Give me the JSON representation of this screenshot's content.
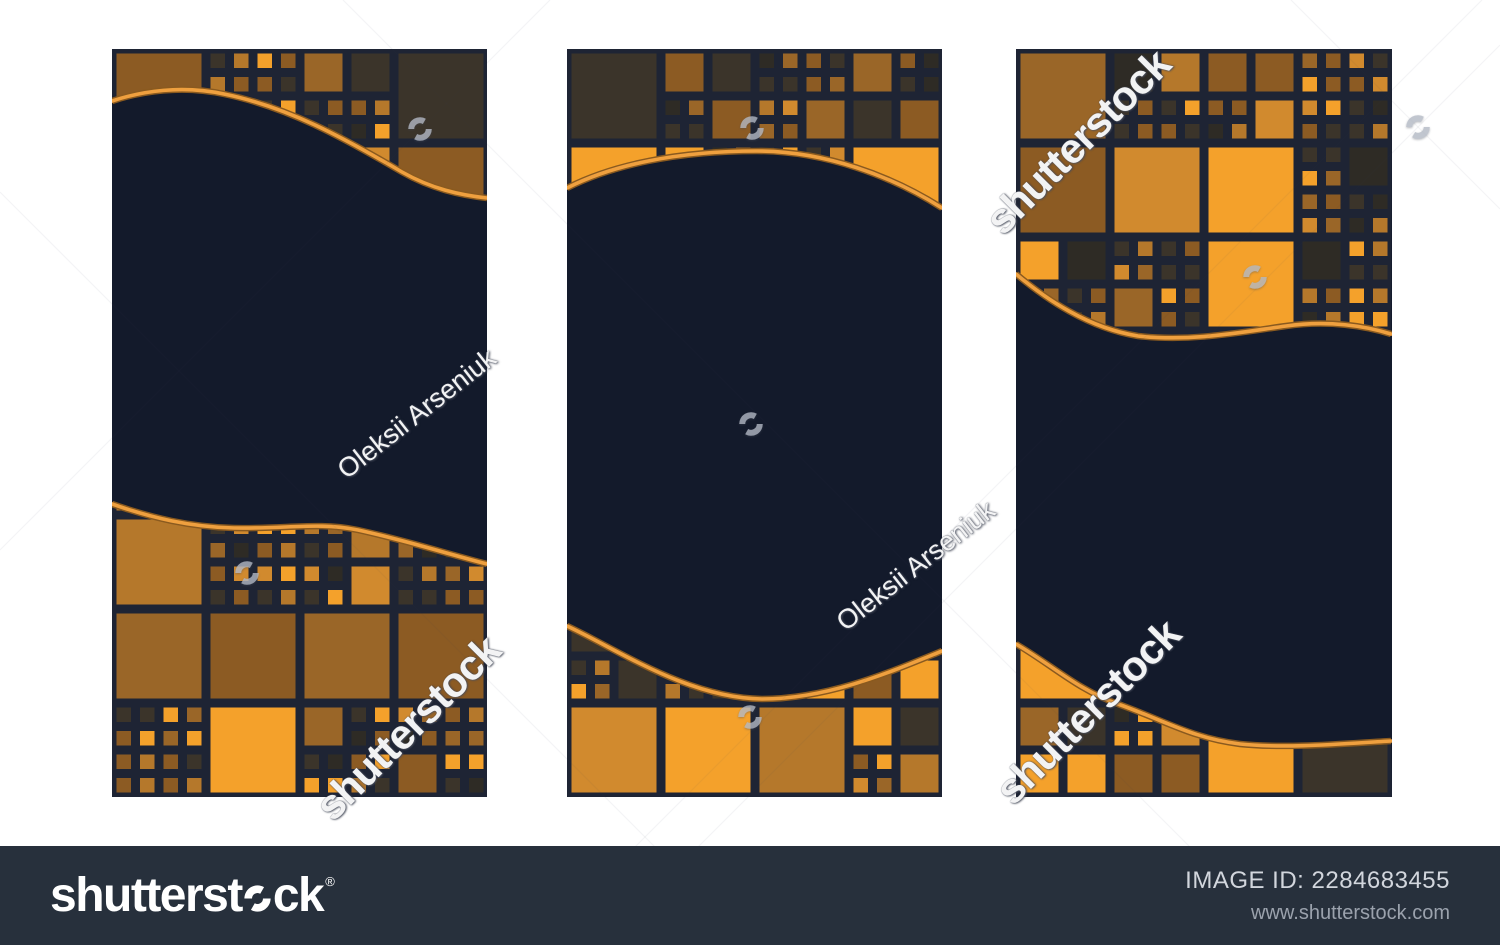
{
  "canvas": {
    "background": "#ffffff",
    "width": 1500,
    "height": 945
  },
  "footer": {
    "bg": "#27303c",
    "logo_prefix": "shutterst",
    "logo_suffix": "ck",
    "registered": "®",
    "image_id": "IMAGE ID: 2284683455",
    "website": "www.shutterstock.com"
  },
  "artwork": {
    "panel_bg": "#131a2b",
    "mosaic_bg": "#1e2434",
    "wave_stroke_outer": "#8a5a1f",
    "wave_stroke_inner": "#efa03f",
    "palette": [
      {
        "c": "#8c5b23",
        "w": 22
      },
      {
        "c": "#9a6628",
        "w": 14
      },
      {
        "c": "#b5782b",
        "w": 16
      },
      {
        "c": "#f4a12b",
        "w": 15
      },
      {
        "c": "#3b342a",
        "w": 18
      },
      {
        "c": "#2e2b25",
        "w": 10
      },
      {
        "c": "#d18a2e",
        "w": 5
      }
    ],
    "panels": [
      {
        "x": 112,
        "y": 49,
        "w": 375,
        "h": 748,
        "top": {
          "wave": "M0,52 C30,42 70,36 112,45 C176,58 232,89 290,123 C320,140 348,146 375,149",
          "extent": 160,
          "seed": 3
        },
        "bottom": {
          "wave": "M0,455 C40,469 78,478 122,479 C176,480 206,473 246,481 C296,492 336,505 375,515",
          "extent": 445,
          "seed": 8
        }
      },
      {
        "x": 567,
        "y": 49,
        "w": 375,
        "h": 748,
        "top": {
          "wave": "M0,139 C45,116 110,102 190,102 C258,102 325,127 375,159",
          "extent": 170,
          "seed": 5
        },
        "bottom": {
          "wave": "M0,577 C50,600 120,649 195,650 C262,650 326,622 375,602",
          "extent": 565,
          "seed": 11
        }
      },
      {
        "x": 1016,
        "y": 49,
        "w": 376,
        "h": 748,
        "top": {
          "wave": "M0,225 C30,250 72,279 122,287 C176,293 226,283 270,277 C312,271 350,277 375,285",
          "extent": 298,
          "seed": 2
        },
        "bottom": {
          "wave": "M0,595 C36,616 62,641 102,655 C152,673 176,689 224,695 C272,700 336,694 375,692",
          "extent": 585,
          "seed": 9
        }
      }
    ]
  },
  "watermarks": {
    "icon_color": "#b2b8c4",
    "texts": [
      {
        "text": "shutterstock",
        "x": 408,
        "y": 728,
        "rot": -45,
        "size": 42,
        "kind": "brand"
      },
      {
        "text": "shutterstock",
        "x": 1078,
        "y": 142,
        "rot": -45,
        "size": 42,
        "kind": "brand"
      },
      {
        "text": "shutterstock",
        "x": 1088,
        "y": 712,
        "rot": -45,
        "size": 42,
        "kind": "brand"
      },
      {
        "text": "Oleksii Arseniuk",
        "x": 417,
        "y": 414,
        "rot": -38,
        "size": 27,
        "kind": "credit"
      },
      {
        "text": "Oleksii Arseniuk",
        "x": 916,
        "y": 566,
        "rot": -38,
        "size": 27,
        "kind": "credit"
      }
    ],
    "icons": [
      {
        "x": 420,
        "y": 129
      },
      {
        "x": 247,
        "y": 573
      },
      {
        "x": 752,
        "y": 128
      },
      {
        "x": 751,
        "y": 424
      },
      {
        "x": 750,
        "y": 717
      },
      {
        "x": 1255,
        "y": 277
      },
      {
        "x": 1418,
        "y": 127
      }
    ],
    "lattice_lines": [
      [
        0,
        192,
        753,
        945
      ],
      [
        537,
        945,
        1482,
        0
      ],
      [
        1291,
        0,
        1500,
        209
      ],
      [
        600,
        945,
        1500,
        45
      ],
      [
        343,
        0,
        1288,
        945
      ],
      [
        0,
        550,
        550,
        0
      ]
    ]
  }
}
